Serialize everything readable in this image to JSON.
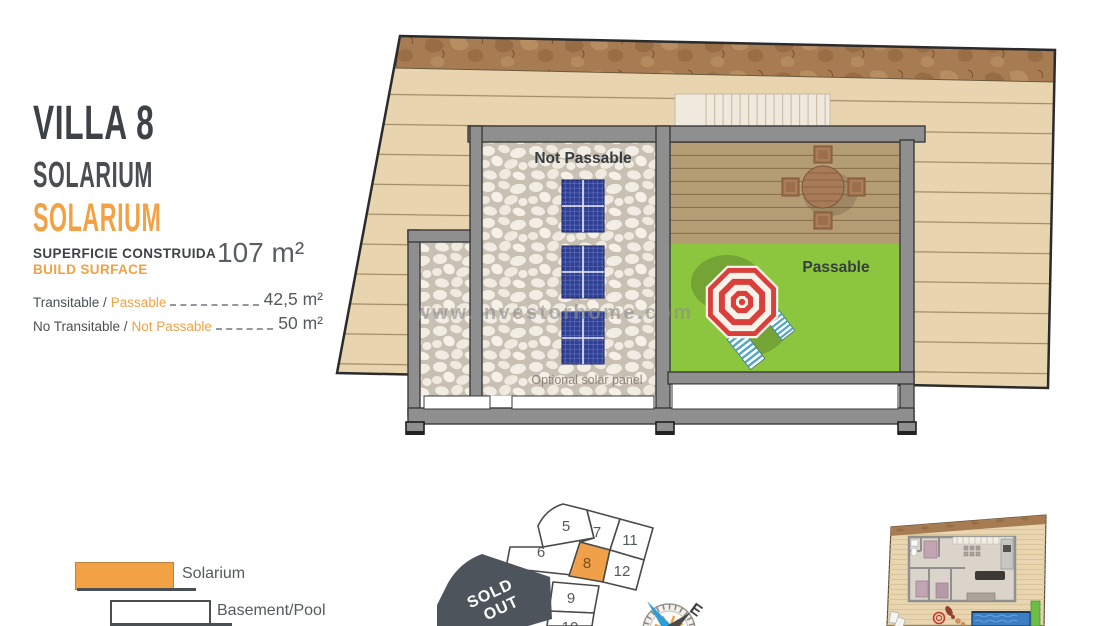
{
  "info_panel": {
    "title": "VILLA 8",
    "subtitle": "SOLARIUM",
    "subtitle_translated": "SOLARIUM",
    "build_surface": {
      "label_es": "SUPERFICIE CONSTRUIDA",
      "label_en": "BUILD SURFACE",
      "value": "107 m²"
    },
    "areas": [
      {
        "label_es": "Transitable /",
        "label_en": "Passable",
        "value": "42,5 m²"
      },
      {
        "label_es": "No Transitable /",
        "label_en": "Not Passable",
        "value": "50 m²"
      }
    ]
  },
  "floor_plan": {
    "labels": {
      "not_passable": "Not Passable",
      "passable": "Passable",
      "optional_solar_panel": "Optional solar panel"
    },
    "watermark": "www.investorhome.com"
  },
  "legend": {
    "items": [
      {
        "label": "Solarium",
        "color": "#F0A049"
      },
      {
        "label": "Basement/Pool",
        "color": "#FFFFFF"
      }
    ]
  },
  "site_map": {
    "parcels": [
      {
        "label": "5"
      },
      {
        "label": "7"
      },
      {
        "label": "11"
      },
      {
        "label": "6"
      },
      {
        "label": "8"
      },
      {
        "label": "12"
      },
      {
        "label": "9"
      },
      {
        "label": "10"
      }
    ],
    "highlighted_parcel": "8",
    "sold_out_lines": [
      "SOLD",
      "OUT"
    ],
    "compass_east": "E"
  },
  "colors": {
    "accent_orange": "#F2A144",
    "heading_gray": "#43474C",
    "plot_beige": "#E8D5B0",
    "terrain_brown": "#A87C52",
    "wall_gray": "#8F8F8F",
    "lawn_green": "#8CC63E",
    "solar_blue": "#2F3F94",
    "umbrella_red": "#D9403C",
    "lounger_blue": "#57AAC9",
    "deck_brown": "#B49C74",
    "sold_out_slate": "#4D545C",
    "compass_blue": "#2D9FD8",
    "pool_blue": "#3D7FC4"
  }
}
